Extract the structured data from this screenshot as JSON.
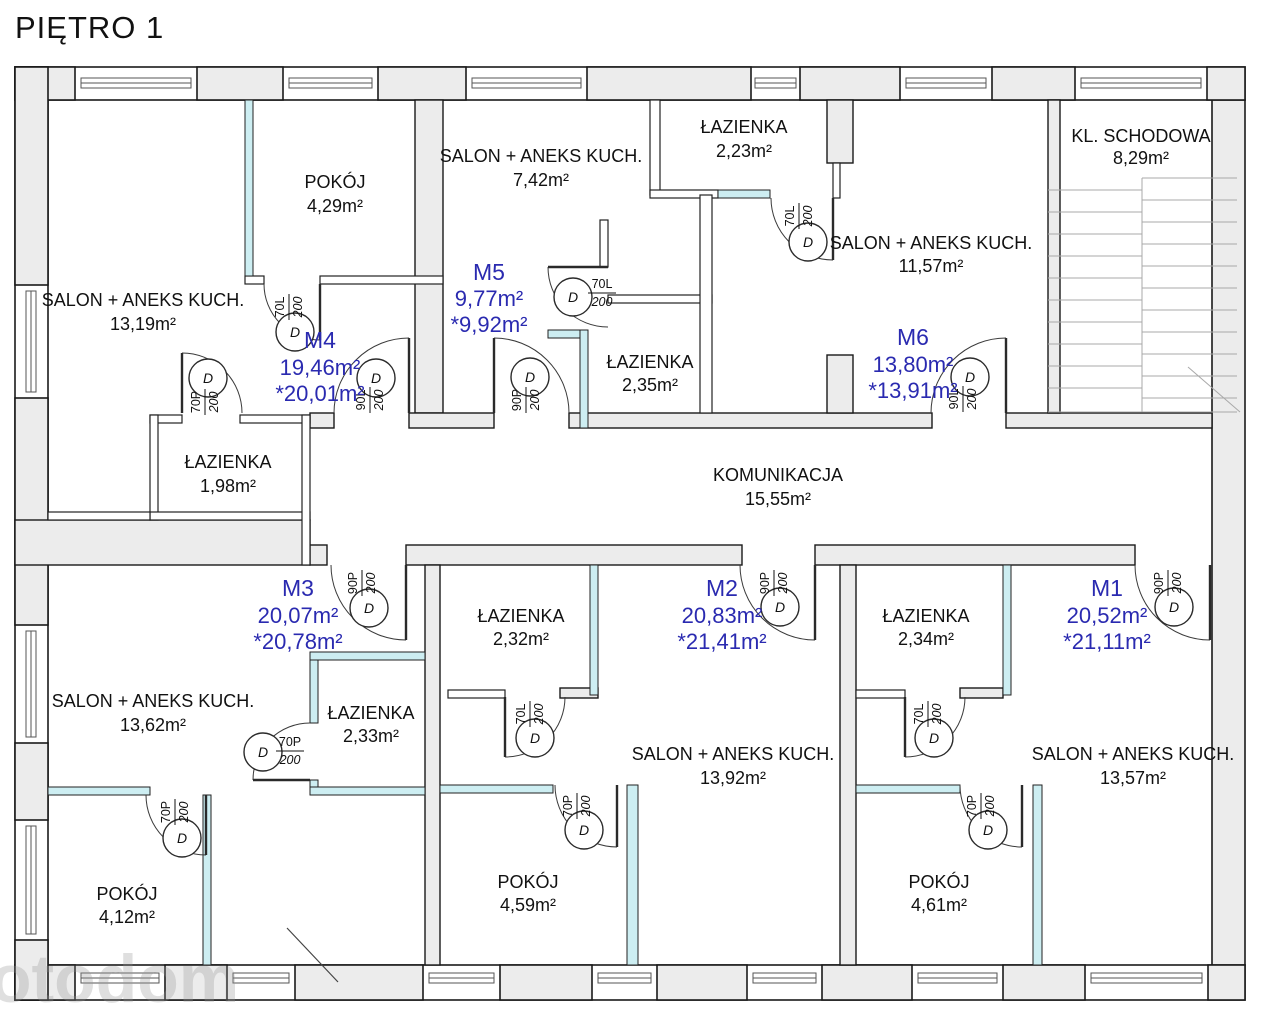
{
  "title": "PIĘTRO 1",
  "watermark": "otodom",
  "colors": {
    "accent": "#2a2ab0",
    "wall_fill": "#ececec",
    "partition_fill": "#cdeef2"
  },
  "door_symbol": "D",
  "apartments": [
    {
      "id": "M1",
      "area": "20,52m²",
      "area_alt": "*21,11m²"
    },
    {
      "id": "M2",
      "area": "20,83m²",
      "area_alt": "*21,41m²"
    },
    {
      "id": "M3",
      "area": "20,07m²",
      "area_alt": "*20,78m²"
    },
    {
      "id": "M4",
      "area": "19,46m²",
      "area_alt": "*20,01m²"
    },
    {
      "id": "M5",
      "area": "9,77m²",
      "area_alt": "*9,92m²"
    },
    {
      "id": "M6",
      "area": "13,80m²",
      "area_alt": "*13,91m²"
    }
  ],
  "rooms": [
    {
      "name": "SALON + ANEKS KUCH.",
      "area": "13,19m²"
    },
    {
      "name": "POKÓJ",
      "area": "4,29m²"
    },
    {
      "name": "ŁAZIENKA",
      "area": "1,98m²"
    },
    {
      "name": "SALON + ANEKS KUCH.",
      "area": "7,42m²"
    },
    {
      "name": "ŁAZIENKA",
      "area": "2,35m²"
    },
    {
      "name": "ŁAZIENKA",
      "area": "2,23m²"
    },
    {
      "name": "SALON + ANEKS KUCH.",
      "area": "11,57m²"
    },
    {
      "name": "KL. SCHODOWA",
      "area": "8,29m²"
    },
    {
      "name": "KOMUNIKACJA",
      "area": "15,55m²"
    },
    {
      "name": "SALON + ANEKS KUCH.",
      "area": "13,62m²"
    },
    {
      "name": "ŁAZIENKA",
      "area": "2,33m²"
    },
    {
      "name": "POKÓJ",
      "area": "4,12m²"
    },
    {
      "name": "ŁAZIENKA",
      "area": "2,32m²"
    },
    {
      "name": "SALON + ANEKS KUCH.",
      "area": "13,92m²"
    },
    {
      "name": "POKÓJ",
      "area": "4,59m²"
    },
    {
      "name": "ŁAZIENKA",
      "area": "2,34m²"
    },
    {
      "name": "SALON + ANEKS KUCH.",
      "area": "13,57m²"
    },
    {
      "name": "POKÓJ",
      "area": "4,61m²"
    }
  ],
  "doors": [
    {
      "size": "70L",
      "height": "200"
    },
    {
      "size": "70P",
      "height": "200"
    },
    {
      "size": "90L",
      "height": "200"
    },
    {
      "size": "70L",
      "height": "200"
    },
    {
      "size": "90P",
      "height": "200"
    },
    {
      "size": "70L",
      "height": "200"
    },
    {
      "size": "90L",
      "height": "200"
    },
    {
      "size": "90P",
      "height": "200"
    },
    {
      "size": "70P",
      "height": "200"
    },
    {
      "size": "70P",
      "height": "200"
    },
    {
      "size": "90P",
      "height": "200"
    },
    {
      "size": "70L",
      "height": "200"
    },
    {
      "size": "70P",
      "height": "200"
    },
    {
      "size": "90P",
      "height": "200"
    },
    {
      "size": "70L",
      "height": "200"
    },
    {
      "size": "70P",
      "height": "200"
    }
  ]
}
